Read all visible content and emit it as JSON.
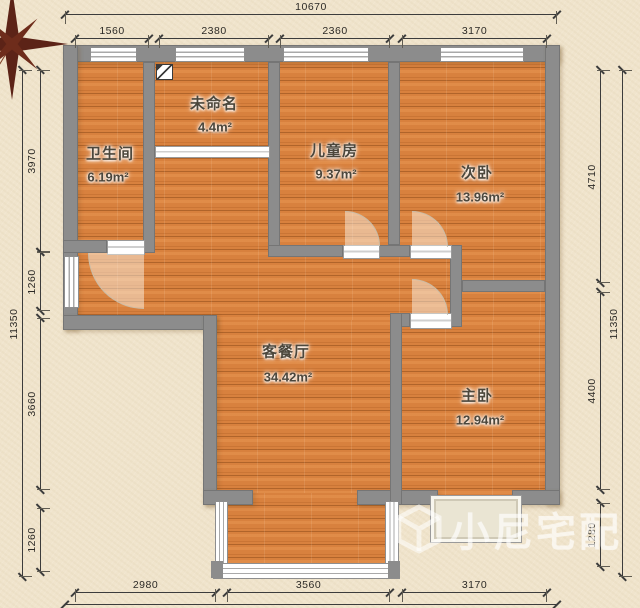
{
  "plan_type": "apartment-floor-plan",
  "rooms": [
    {
      "id": "bathroom",
      "name": "卫生间",
      "area": "6.19m²"
    },
    {
      "id": "unnamed",
      "name": "未命名",
      "area": "4.4m²"
    },
    {
      "id": "kids-room",
      "name": "儿童房",
      "area": "9.37m²"
    },
    {
      "id": "second-bedroom",
      "name": "次卧",
      "area": "13.96m²"
    },
    {
      "id": "living-dining",
      "name": "客餐厅",
      "area": "34.42m²"
    },
    {
      "id": "master-bedroom",
      "name": "主卧",
      "area": "12.94m²"
    }
  ],
  "dims": {
    "top": {
      "total": "10670",
      "segments": [
        "1560",
        "2380",
        "2360",
        "3170"
      ]
    },
    "bottom": {
      "segments": [
        "2980",
        "3560",
        "3170"
      ]
    },
    "left": {
      "total": "11350",
      "segments": [
        "3970",
        "1260",
        "3660",
        "1260"
      ]
    },
    "right": {
      "total": "11350",
      "segments": [
        "4710",
        "4400",
        "1280"
      ]
    }
  },
  "watermark": {
    "brand": "小尼宅配"
  },
  "icons": [
    "compass-rose-icon",
    "utility-meter-icon",
    "brand-cube-icon"
  ],
  "colors": {
    "canvas": "#f0e4cc",
    "wall": "#8c8c8c",
    "floor_wood": "#d8813e",
    "dimension": "#3c3c3c",
    "compass": "#5c2317",
    "watermark": "rgba(255,255,255,0.55)"
  }
}
